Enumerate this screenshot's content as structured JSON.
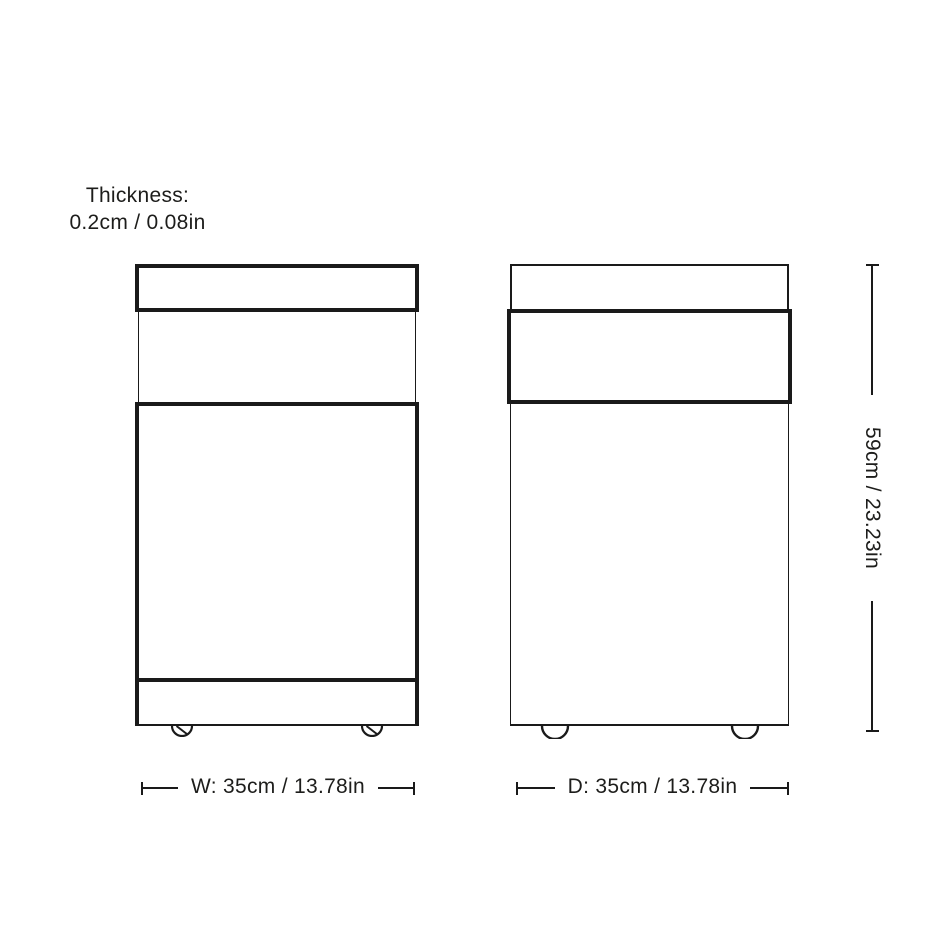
{
  "colors": {
    "line": "#1a1a1a",
    "text": "#1d1d1b",
    "background": "#ffffff"
  },
  "annotations": {
    "thickness": {
      "title": "Thickness:",
      "value": "0.2cm / 0.08in"
    },
    "width_dimension": {
      "label": "W: 35cm / 13.78in"
    },
    "depth_dimension": {
      "label": "D: 35cm / 13.78in"
    },
    "height_dimension": {
      "label": "59cm / 23.23in"
    }
  }
}
